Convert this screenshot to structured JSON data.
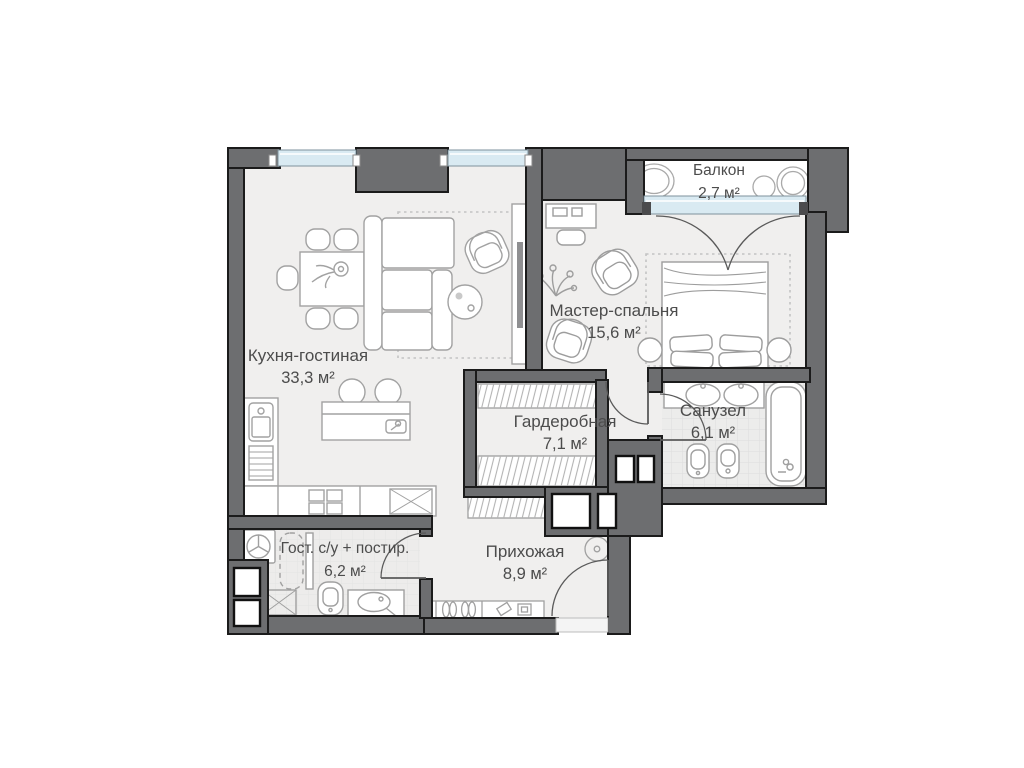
{
  "plan": {
    "type": "apartment-floor-plan",
    "units": "м²"
  },
  "rooms": [
    {
      "id": "kitchen-living",
      "name": "Кухня-гостиная",
      "area": "33,3 м²"
    },
    {
      "id": "master-bedroom",
      "name": "Мастер-спальня",
      "area": "15,6 м²"
    },
    {
      "id": "balcony",
      "name": "Балкон",
      "area": "2,7 м²"
    },
    {
      "id": "wardrobe",
      "name": "Гардеробная",
      "area": "7,1 м²"
    },
    {
      "id": "bathroom",
      "name": "Санузел",
      "area": "6,1 м²"
    },
    {
      "id": "guest-wc",
      "name": "Гост. с/у + постир.",
      "area": "6,2 м²"
    },
    {
      "id": "hallway",
      "name": "Прихожая",
      "area": "8,9 м²"
    }
  ],
  "legend_symbols": [
    "dining-table",
    "dining-chair",
    "sofa",
    "armchair",
    "coffee-table",
    "tv-console",
    "kitchen-island",
    "bar-stool",
    "kitchen-sink",
    "cooktop",
    "double-bed",
    "pillow",
    "nightstand",
    "desk",
    "plant",
    "wardrobe-rack",
    "vanity-sinks",
    "bathtub",
    "toilet",
    "bidet",
    "washing-machine",
    "drying-rack",
    "shower-tray",
    "shoe-cabinet",
    "entrance-door",
    "door-swing",
    "window",
    "balcony-door",
    "utility-shaft",
    "spotlight"
  ],
  "colors": {
    "wall_fill": "#6d6e70",
    "wall_outline": "#1b1b1b",
    "window_glass": "#d9eaf2",
    "floor": "#f0efee",
    "tile": "#ececeb",
    "furniture_stroke": "#a2a2a2",
    "label_text": "#4c4c4c"
  }
}
